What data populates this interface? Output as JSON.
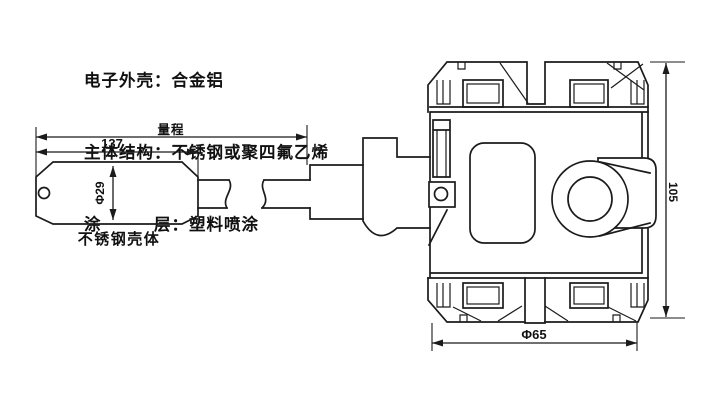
{
  "notes": {
    "line1": "电子外壳：合金铝",
    "line2": "主体结构：不锈钢或聚四氟乙烯",
    "line3": "涂　　　层：塑料喷涂"
  },
  "labels": {
    "probe_body": "不锈钢壳体"
  },
  "dims": {
    "range": "量程",
    "probe_length": "137",
    "probe_diameter": "Φ29",
    "housing_height": "105",
    "housing_diameter": "Φ65"
  },
  "colors": {
    "line": "#1b1b1b",
    "background": "#ffffff"
  }
}
